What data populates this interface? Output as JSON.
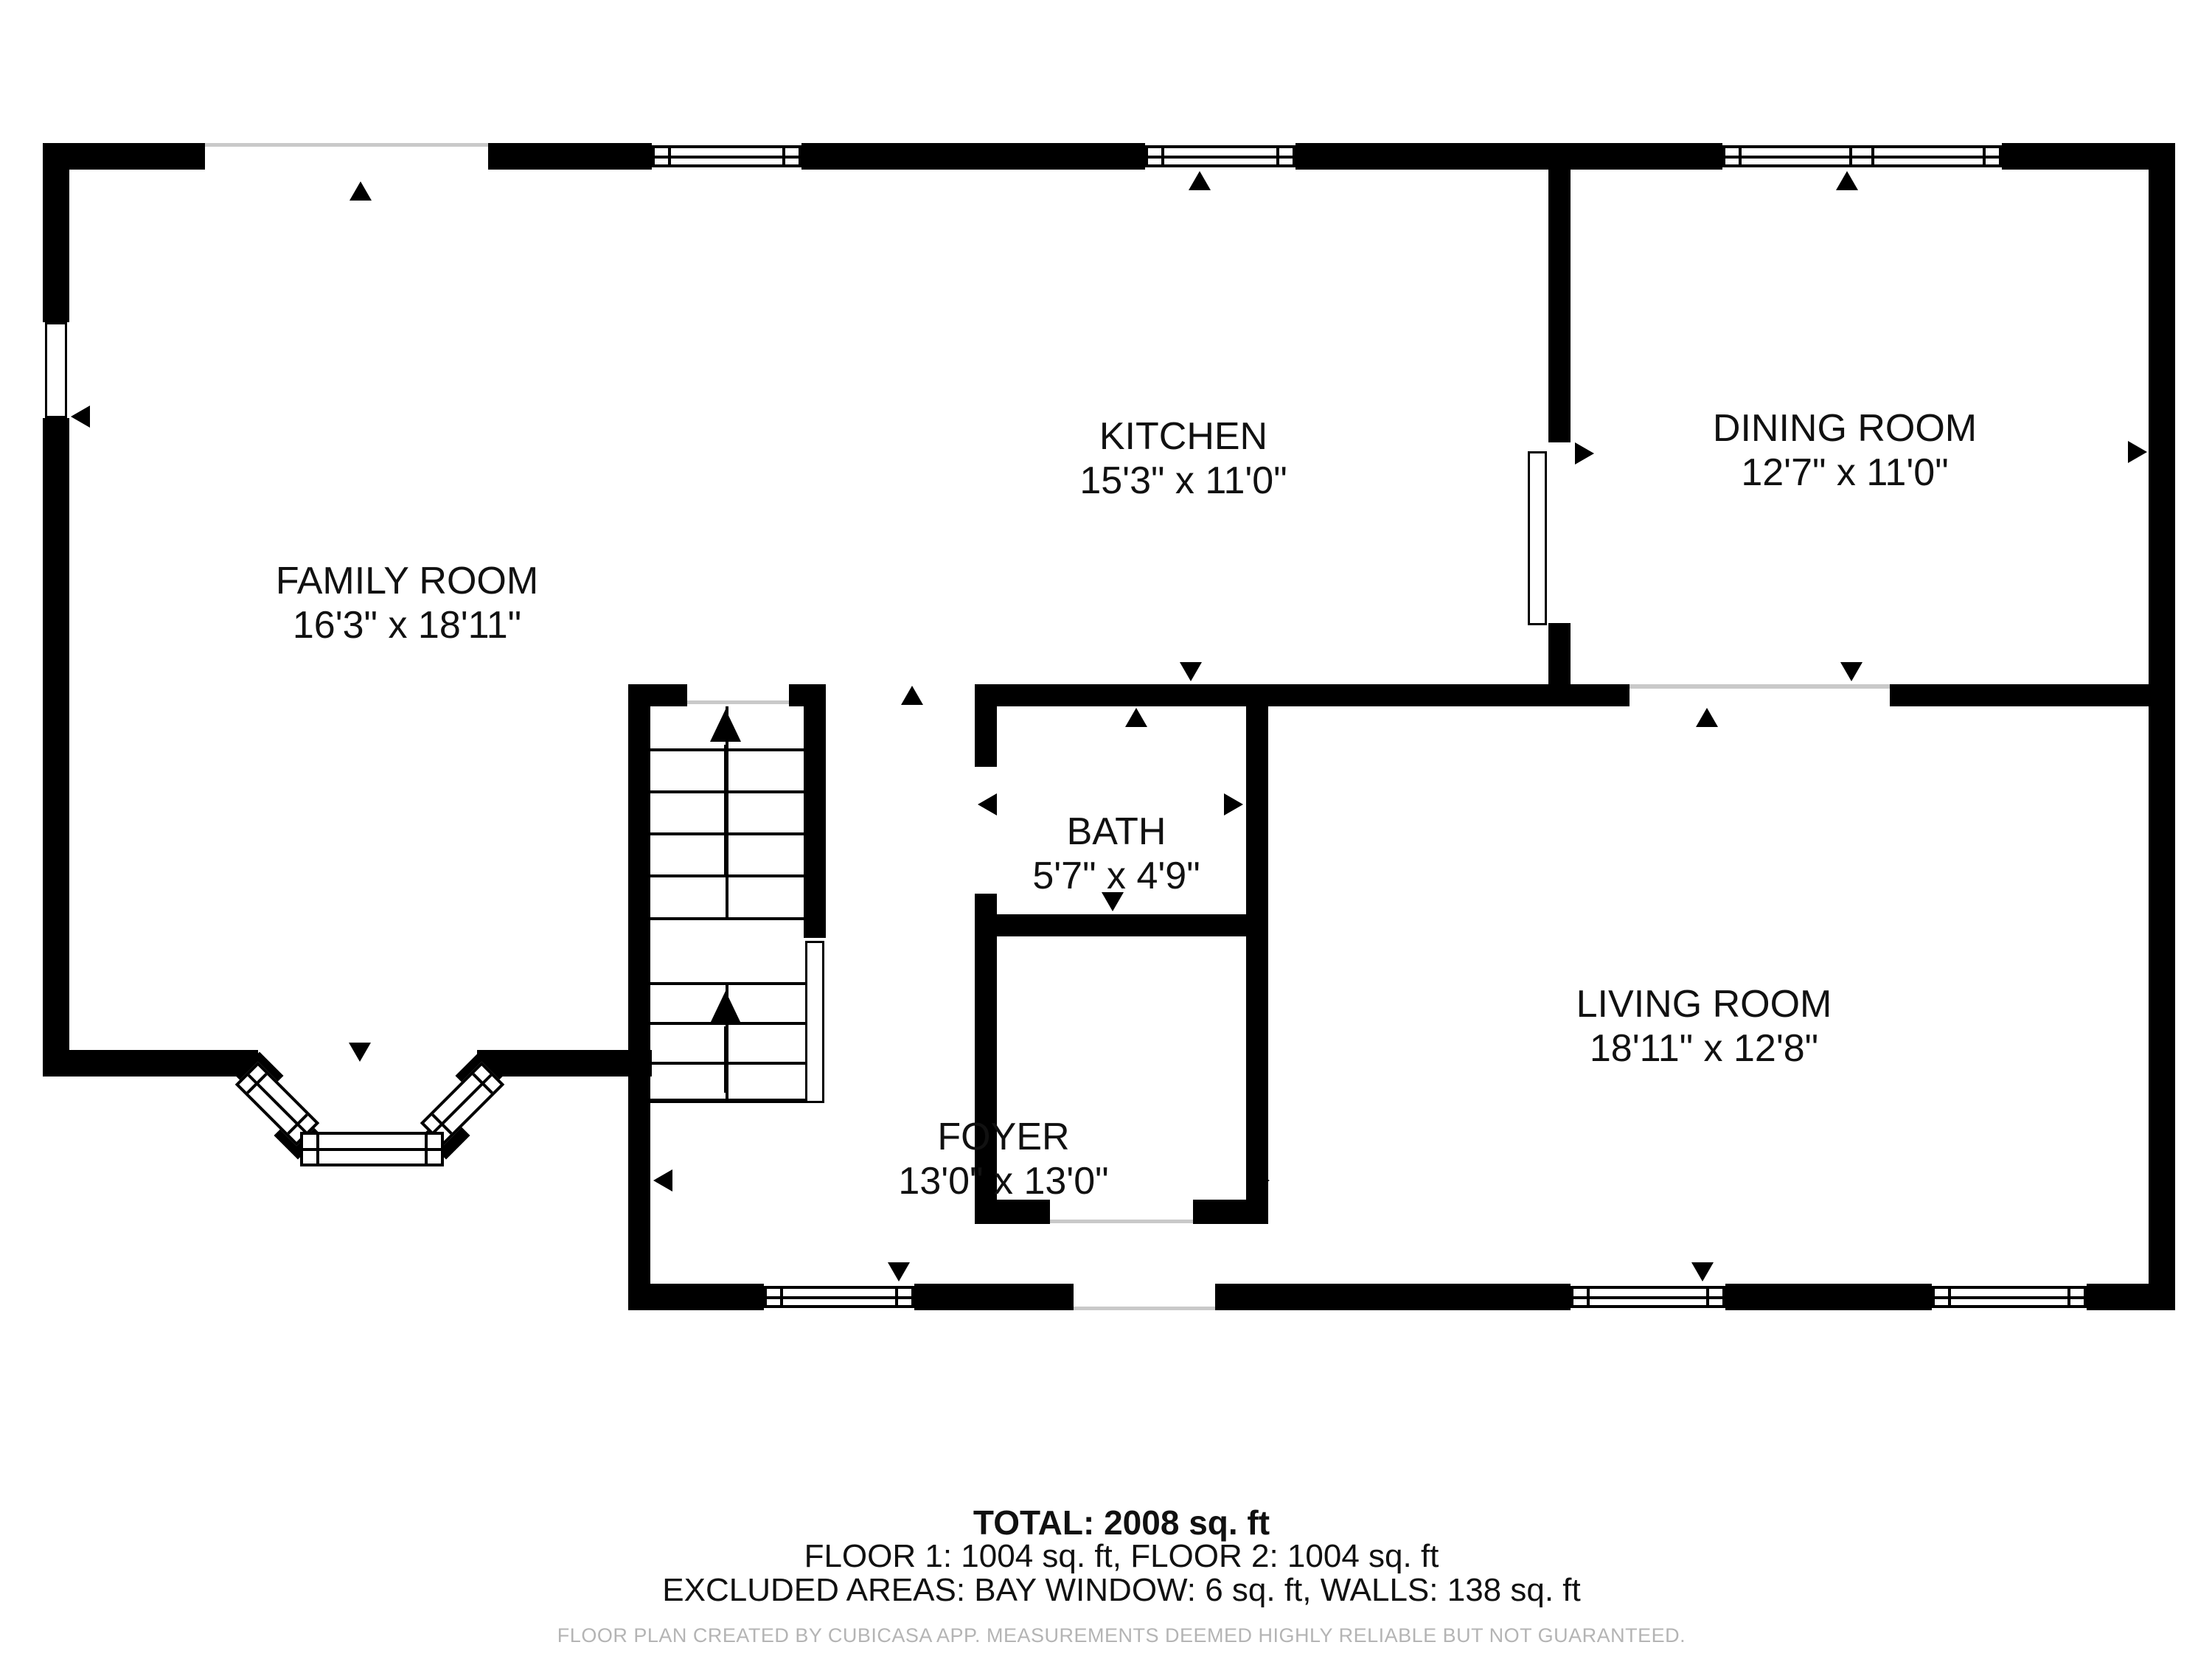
{
  "rooms": {
    "family": {
      "name": "FAMILY ROOM",
      "dims": "16'3\" x 18'11\""
    },
    "kitchen": {
      "name": "KITCHEN",
      "dims": "15'3\" x 11'0\""
    },
    "dining": {
      "name": "DINING ROOM",
      "dims": "12'7\" x 11'0\""
    },
    "bath": {
      "name": "BATH",
      "dims": "5'7\" x 4'9\""
    },
    "living": {
      "name": "LIVING ROOM",
      "dims": "18'11\" x 12'8\""
    },
    "foyer": {
      "name": "FOYER",
      "dims": "13'0\" x 13'0\""
    }
  },
  "summary": {
    "total": "TOTAL: 2008 sq. ft",
    "floors": "FLOOR 1: 1004 sq. ft, FLOOR 2: 1004 sq. ft",
    "excluded": "EXCLUDED AREAS: BAY WINDOW: 6 sq. ft, WALLS: 138 sq. ft"
  },
  "footer": "FLOOR PLAN CREATED BY CUBICASA APP. MEASUREMENTS DEEMED HIGHLY RELIABLE BUT NOT GUARANTEED.",
  "colors": {
    "wall": "#000000",
    "background": "#ffffff",
    "label_text": "#111111",
    "footer_text": "#b4b4b4",
    "threshold_line": "#c9c9c9"
  }
}
